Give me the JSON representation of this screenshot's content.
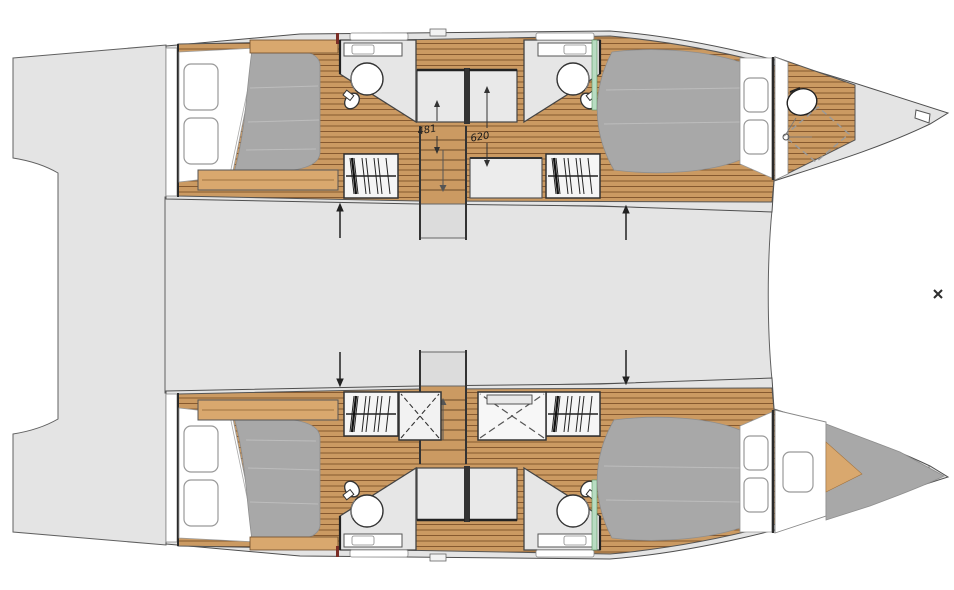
{
  "drawing": {
    "type": "catamaran-interior-floor-plan",
    "annotations": {
      "dim_small": "481",
      "dim_large": "620"
    },
    "colors": {
      "background": "#ffffff",
      "deck_gray": "#e4e4e4",
      "outline": "#4f4f4f",
      "wood": "#cb9a62",
      "wood_line": "#86592f",
      "wood_light": "#d9a86e",
      "mattress_gray": "#a8a8a8",
      "fixture_white": "#ffffff",
      "wall_dark": "#2a2a2a",
      "glass_green": "#b8dcc2",
      "accent_red": "#7b2d26"
    },
    "features": [
      "stern-platform",
      "bridge-deck",
      "aft-cabin-bed",
      "pillows",
      "bench",
      "bathroom-shower-circle",
      "toilet",
      "vanity-sink",
      "central-shower-stalls",
      "wardrobe-hanging-clothes",
      "staircase",
      "forward-cabin-bed",
      "forward-head-toilet",
      "forward-shower-dashed",
      "v-berth-bed",
      "anchor-notch",
      "bow-marker"
    ]
  }
}
